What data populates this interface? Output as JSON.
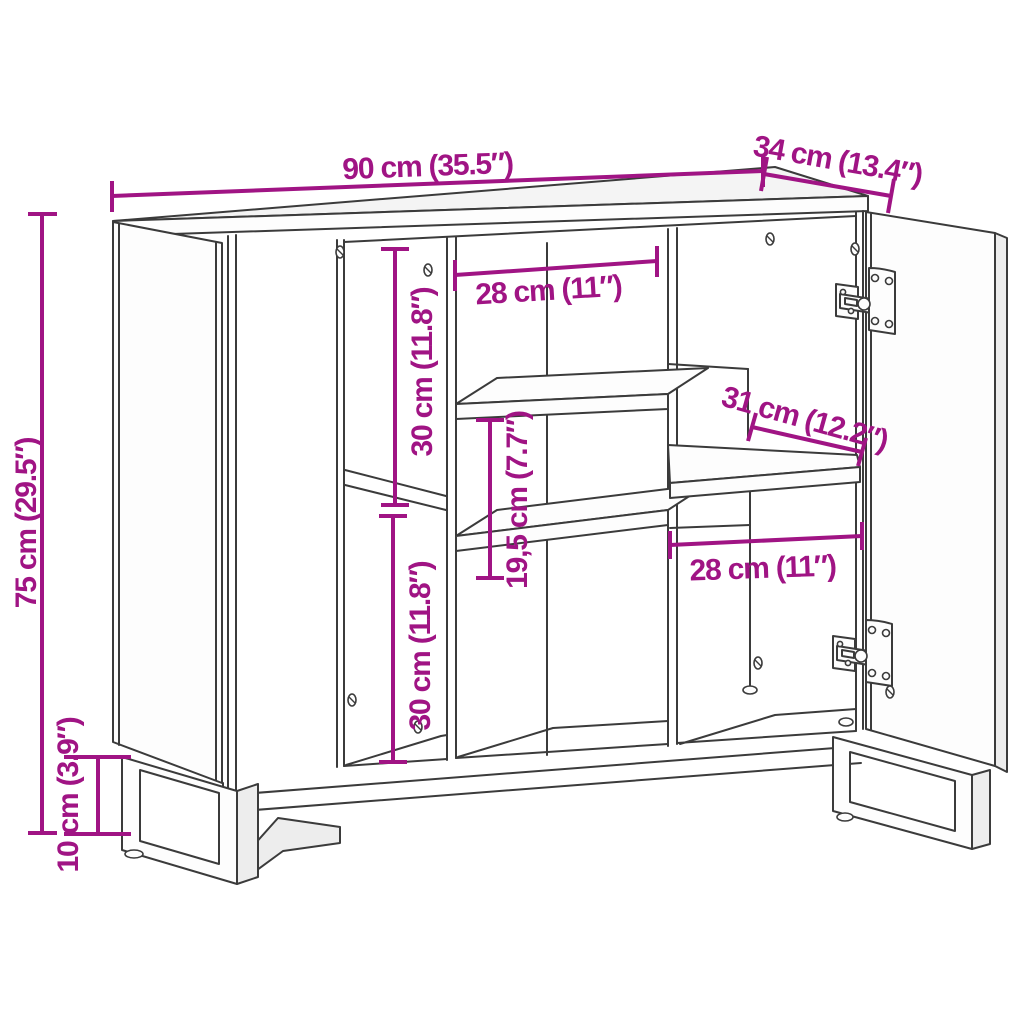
{
  "diagram": {
    "background_color": "#ffffff",
    "line_color": "#3b3b3b",
    "accent_color": "#a01484",
    "dimensions": {
      "overall_width": {
        "label": "90 cm (35.5″)"
      },
      "overall_depth": {
        "label": "34 cm (13.4″)"
      },
      "overall_height": {
        "label": "75 cm (29.5″)"
      },
      "leg_height": {
        "label": "10 cm (3.9″)"
      },
      "middle_compartment_width": {
        "label": "28 cm (11″)"
      },
      "left_upper_compartment_height": {
        "label": "30 cm (11.8″)"
      },
      "left_lower_compartment_height": {
        "label": "30 cm (11.8″)"
      },
      "middle_shelf_spacing": {
        "label": "19,5 cm (7.7″)"
      },
      "right_shelf_depth": {
        "label": "31 cm (12.2″)"
      },
      "right_compartment_width": {
        "label": "28 cm (11″)"
      }
    }
  }
}
